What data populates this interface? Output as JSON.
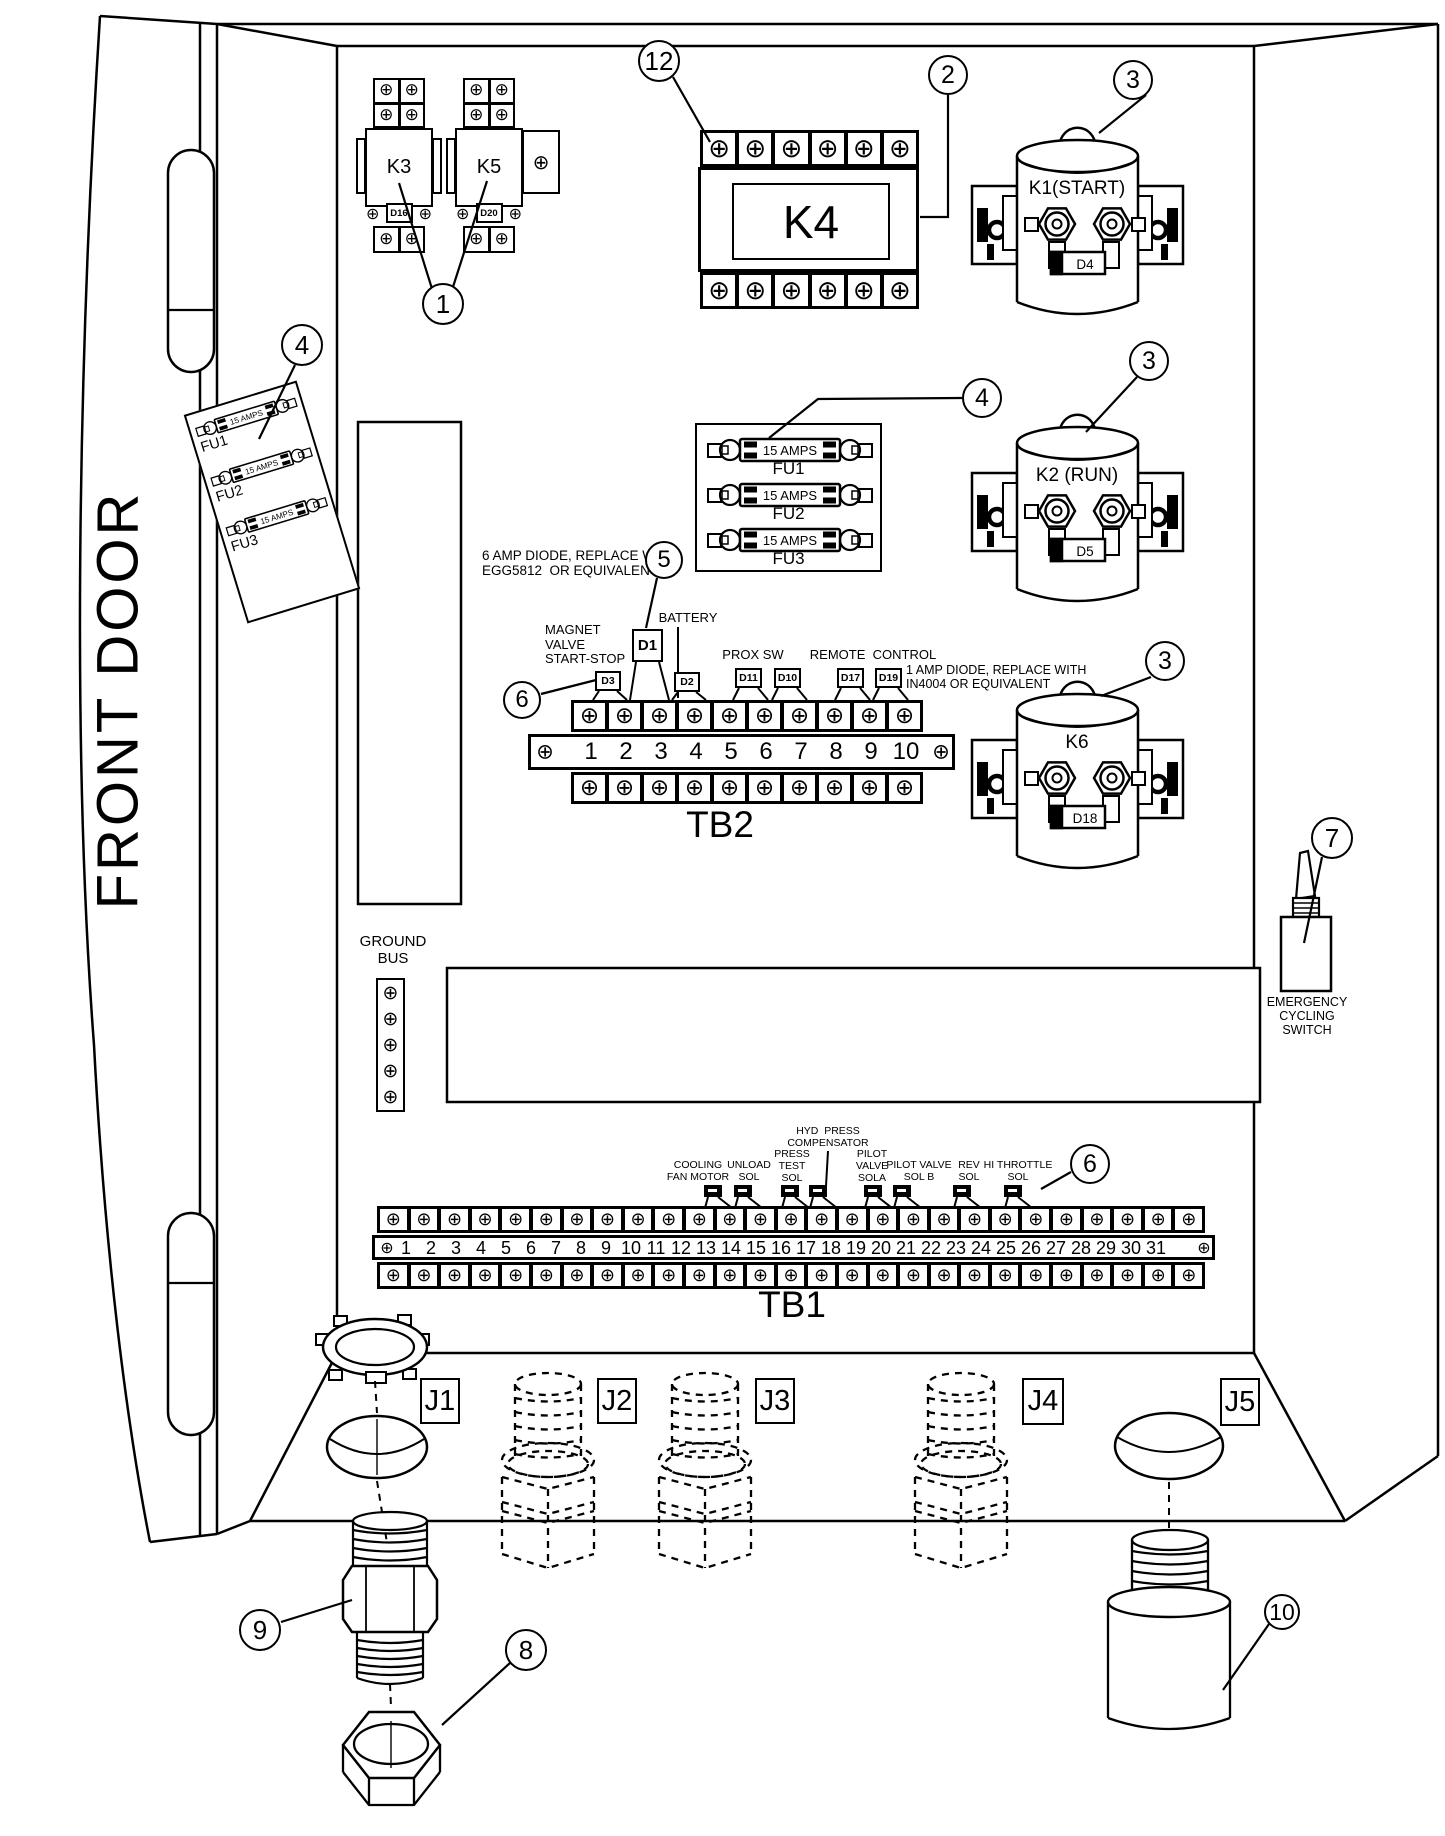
{
  "title": "Control panel front door component location diagram",
  "door": {
    "label": "FRONT DOOR"
  },
  "relays": [
    {
      "id": "k3",
      "label": "K3",
      "diode": "D16",
      "x": 365,
      "y": 78,
      "big_right_bracket": false
    },
    {
      "id": "k5",
      "label": "K5",
      "diode": "D20",
      "x": 455,
      "y": 78,
      "big_right_bracket": true
    }
  ],
  "k4": {
    "label": "K4",
    "x": 698,
    "y": 130
  },
  "solenoids": [
    {
      "id": "k1",
      "label": "K1(START)",
      "diode": "D4",
      "x": 975,
      "y": 118
    },
    {
      "id": "k2",
      "label": "K2 (RUN)",
      "diode": "D5",
      "x": 975,
      "y": 405
    },
    {
      "id": "k6",
      "label": "K6",
      "diode": "D18",
      "x": 975,
      "y": 672
    }
  ],
  "fuse_block": {
    "x": 695,
    "y": 423,
    "w": 187,
    "h": 149,
    "fuses": [
      {
        "rating": "15 AMPS",
        "label": "FU1"
      },
      {
        "rating": "15 AMPS",
        "label": "FU2"
      },
      {
        "rating": "15 AMPS",
        "label": "FU3"
      }
    ]
  },
  "door_fuse_panel": {
    "x": 213,
    "y": 393,
    "w": 118,
    "h": 218,
    "rotation": -17,
    "fuses": [
      {
        "rating": "15 AMPS",
        "label": "FU1"
      },
      {
        "rating": "15 AMPS",
        "label": "FU2"
      },
      {
        "rating": "15 AMPS",
        "label": "FU3"
      }
    ]
  },
  "tb2": {
    "label": "TB2",
    "terminals": [
      "1",
      "2",
      "3",
      "4",
      "5",
      "6",
      "7",
      "8",
      "9",
      "10"
    ],
    "chips": [
      {
        "label": "D3",
        "x": 595,
        "y": 671,
        "w": 26,
        "h": 20
      },
      {
        "label": "D1",
        "x": 632,
        "y": 629,
        "w": 31,
        "h": 33,
        "tall": true
      },
      {
        "label": "D2",
        "x": 674,
        "y": 672,
        "w": 26,
        "h": 20
      },
      {
        "label": "D11",
        "x": 735,
        "y": 668,
        "w": 27,
        "h": 20
      },
      {
        "label": "D10",
        "x": 774,
        "y": 668,
        "w": 27,
        "h": 20
      },
      {
        "label": "D17",
        "x": 837,
        "y": 668,
        "w": 27,
        "h": 20
      },
      {
        "label": "D19",
        "x": 875,
        "y": 668,
        "w": 27,
        "h": 20
      }
    ]
  },
  "tb1": {
    "label": "TB1",
    "terminals": [
      "1",
      "2",
      "3",
      "4",
      "5",
      "6",
      "7",
      "8",
      "9",
      "10",
      "11",
      "12",
      "13",
      "14",
      "15",
      "16",
      "17",
      "18",
      "19",
      "20",
      "21",
      "22",
      "23",
      "24",
      "25",
      "26",
      "27",
      "28",
      "29",
      "30",
      "31"
    ],
    "diodes": [
      {
        "x": 713
      },
      {
        "x": 743
      },
      {
        "x": 790
      },
      {
        "x": 818
      },
      {
        "x": 873
      },
      {
        "x": 902
      },
      {
        "x": 962
      },
      {
        "x": 1013
      }
    ]
  },
  "ground_bus": {
    "label": "GROUND\nBUS",
    "screw_count": 5
  },
  "emergency_switch": {
    "label": "EMERGENCY\nCYCLING\nSWITCH"
  },
  "connectors": [
    {
      "label": "J1",
      "x": 420,
      "y": 1378,
      "type": "hole-with-locknut"
    },
    {
      "label": "J2",
      "x": 597,
      "y": 1378,
      "type": "dashed-fitting",
      "fit_x": 500
    },
    {
      "label": "J3",
      "x": 755,
      "y": 1378,
      "type": "dashed-fitting",
      "fit_x": 657
    },
    {
      "label": "J4",
      "x": 1022,
      "y": 1378,
      "type": "dashed-fitting",
      "fit_x": 913
    },
    {
      "label": "J5",
      "x": 1220,
      "y": 1378,
      "type": "hole-with-barrel"
    }
  ],
  "annotations": [
    {
      "id": "note-6amp-diode",
      "text": "6 AMP DIODE, REPLACE WITH\nEGG5812  OR EQUIVALENT",
      "x": 482,
      "y": 548,
      "align": "left",
      "size": 13.5
    },
    {
      "id": "label-magnet-valve",
      "text": "MAGNET\nVALVE\nSTART-STOP",
      "x": 545,
      "y": 623,
      "align": "left",
      "size": 13
    },
    {
      "id": "label-battery",
      "text": "BATTERY",
      "x": 688,
      "y": 611,
      "align": "center",
      "size": 13
    },
    {
      "id": "label-prox-sw",
      "text": "PROX SW",
      "x": 753,
      "y": 648,
      "align": "center",
      "size": 13
    },
    {
      "id": "label-remote-control",
      "text": "REMOTE  CONTROL",
      "x": 873,
      "y": 648,
      "align": "center",
      "size": 13
    },
    {
      "id": "note-1amp-diode",
      "text": "1 AMP DIODE, REPLACE WITH\nIN4004 OR EQUIVALENT",
      "x": 906,
      "y": 663,
      "align": "left",
      "size": 12.5
    },
    {
      "id": "label-ground-bus",
      "text": "GROUND\nBUS",
      "x": 393,
      "y": 934,
      "align": "center",
      "size": 15
    },
    {
      "id": "label-emergency",
      "text": "EMERGENCY\nCYCLING\nSWITCH",
      "x": 1307,
      "y": 995,
      "align": "center",
      "size": 12.5
    },
    {
      "id": "label-cooling-fan",
      "text": "COOLING\nFAN MOTOR",
      "x": 698,
      "y": 1160,
      "align": "center",
      "size": 10.5
    },
    {
      "id": "label-unload-sol",
      "text": "UNLOAD\nSOL",
      "x": 749,
      "y": 1160,
      "align": "center",
      "size": 10.5
    },
    {
      "id": "label-press-test",
      "text": "PRESS\nTEST\nSOL",
      "x": 792,
      "y": 1149,
      "align": "center",
      "size": 10.5
    },
    {
      "id": "label-hyd-press",
      "text": "HYD  PRESS\nCOMPENSATOR",
      "x": 828,
      "y": 1126,
      "align": "center",
      "size": 10.5
    },
    {
      "id": "label-pilot-sola",
      "text": "PILOT\nVALVE\nSOLA",
      "x": 872,
      "y": 1149,
      "align": "center",
      "size": 10.5
    },
    {
      "id": "label-pilot-solb",
      "text": "PILOT VALVE\nSOL B",
      "x": 919,
      "y": 1160,
      "align": "center",
      "size": 10.5
    },
    {
      "id": "label-rev-sol",
      "text": "REV\nSOL",
      "x": 969,
      "y": 1160,
      "align": "center",
      "size": 10.5
    },
    {
      "id": "label-hi-throttle",
      "text": "HI THROTTLE\nSOL",
      "x": 1018,
      "y": 1160,
      "align": "center",
      "size": 10.5
    }
  ],
  "callouts": [
    {
      "num": "1",
      "name": "callout-1-relays",
      "x": 443,
      "y": 304,
      "r": 21,
      "lines": [
        [
          [
            433,
            292
          ],
          [
            399,
            183
          ]
        ],
        [
          [
            452,
            290
          ],
          [
            487,
            181
          ]
        ]
      ]
    },
    {
      "num": "2",
      "name": "callout-2-k4",
      "x": 948,
      "y": 75,
      "r": 20,
      "lines": [
        [
          [
            948,
            95
          ],
          [
            948,
            217
          ],
          [
            920,
            217
          ]
        ]
      ]
    },
    {
      "num": "3",
      "name": "callout-3-k1",
      "x": 1133,
      "y": 80,
      "r": 20,
      "lines": [
        [
          [
            1146,
            95
          ],
          [
            1099,
            133
          ]
        ]
      ]
    },
    {
      "num": "3",
      "name": "callout-3-k2",
      "x": 1149,
      "y": 361,
      "r": 20,
      "lines": [
        [
          [
            1137,
            377
          ],
          [
            1086,
            432
          ]
        ]
      ]
    },
    {
      "num": "3",
      "name": "callout-3-k6",
      "x": 1165,
      "y": 661,
      "r": 20,
      "lines": [
        [
          [
            1151,
            677
          ],
          [
            1101,
            696
          ]
        ]
      ]
    },
    {
      "num": "4",
      "name": "callout-4-door-fuses",
      "x": 302,
      "y": 345,
      "r": 21,
      "lines": [
        [
          [
            295,
            365
          ],
          [
            259,
            439
          ]
        ]
      ]
    },
    {
      "num": "4",
      "name": "callout-4-fuse-block",
      "x": 982,
      "y": 398,
      "r": 20,
      "lines": [
        [
          [
            962,
            398
          ],
          [
            818,
            399
          ],
          [
            769,
            438
          ]
        ]
      ]
    },
    {
      "num": "5",
      "name": "callout-5-d1",
      "x": 664,
      "y": 560,
      "r": 19,
      "lines": [
        [
          [
            657,
            578
          ],
          [
            646,
            628
          ]
        ]
      ]
    },
    {
      "num": "6",
      "name": "callout-6-tb2",
      "x": 522,
      "y": 700,
      "r": 19,
      "lines": [
        [
          [
            541,
            694
          ],
          [
            596,
            680
          ]
        ]
      ]
    },
    {
      "num": "6",
      "name": "callout-6-tb1",
      "x": 1090,
      "y": 1164,
      "r": 20,
      "lines": [
        [
          [
            1071,
            1172
          ],
          [
            1041,
            1189
          ]
        ]
      ]
    },
    {
      "num": "7",
      "name": "callout-7-emergency-switch",
      "x": 1332,
      "y": 838,
      "r": 21,
      "lines": [
        [
          [
            1322,
            857
          ],
          [
            1304,
            943
          ]
        ]
      ]
    },
    {
      "num": "8",
      "name": "callout-8-hex-nut",
      "x": 526,
      "y": 1650,
      "r": 21,
      "lines": [
        [
          [
            510,
            1663
          ],
          [
            442,
            1725
          ]
        ]
      ]
    },
    {
      "num": "9",
      "name": "callout-9-fitting",
      "x": 260,
      "y": 1630,
      "r": 21,
      "lines": [
        [
          [
            281,
            1622
          ],
          [
            352,
            1600
          ]
        ]
      ]
    },
    {
      "num": "10",
      "name": "callout-10-barrel",
      "x": 1282,
      "y": 1612,
      "r": 18,
      "lines": [
        [
          [
            1269,
            1624
          ],
          [
            1223,
            1690
          ]
        ]
      ]
    },
    {
      "num": "12",
      "name": "callout-12-k4-terminals",
      "x": 659,
      "y": 61,
      "r": 21,
      "lines": [
        [
          [
            673,
            77
          ],
          [
            710,
            142
          ]
        ]
      ]
    }
  ]
}
